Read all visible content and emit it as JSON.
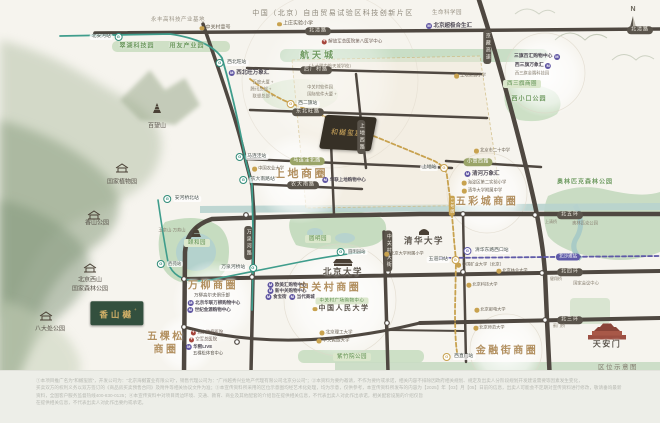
{
  "project": {
    "block_name": "和樾玺宸",
    "block_sup": "+",
    "badge_name": "香山樾",
    "badge_sup": "+"
  },
  "compass": {
    "north_label": "N"
  },
  "footer": {
    "caption": "区位示意图",
    "disclaimer_lines": [
      "①本项目推广名为“和樾玺宸”，开发公司为：“北京海樾置业有限公司”，销售代理公司为：“广州越秀兴业地产代理有限公司北京分公司”；②本资料为要约邀请，不作为要约或承诺，相关内容不排除因政府相关规划、规定及出卖人分阶段规划开发建设需要等因素发生变化，",
      "买卖双方的权利义务以双方签订的《商品房买卖预售合同》及附件等相关协议文件为准；③本宣传资料所采用的区位示意图均经艺术化处理，均为示意，仅供参考，本宣传资料所发布的内容为【2025】年【03】月【05】日前的信息，出卖人可能会不定期对宣传资料进行修改，敬请垂询最新",
      "资料，全国客户服务监督热线400-830-0125；④本宣传资料中对项目周边环境、交通、教育、商业及其他配套的介绍旨在提供相关信息，不代表出卖人对此作出承诺，相关配套设施的介绍仅旨",
      "在提供相关信息，不代表出卖人对此作出要约或承诺。"
    ]
  },
  "colors": {
    "road": "#4f4841",
    "metro_green": "#3f9d8c",
    "metro_gold": "#c8a24f",
    "metro_purple": "#5f5aa8",
    "district_text": "#b29060",
    "park_fill": "#cddec3",
    "water_fill": "#b4d2cd",
    "badge_green": "#33503e",
    "badge_gold": "#d2b068"
  },
  "map": {
    "labels": [
      {
        "n": "label-north",
        "t": "N",
        "x": 633,
        "y": 10,
        "c": "north"
      },
      {
        "n": "label-yongfeng-base",
        "t": "永丰高科技产业基地",
        "x": 178,
        "y": 20,
        "c": "gray"
      },
      {
        "n": "label-zgc-no1",
        "t": "中关村壹号",
        "x": 215,
        "y": 28,
        "c": "school",
        "fs": 5
      },
      {
        "n": "label-ftz-title",
        "t": "中国（北京）自由贸易试验区科技创新片区",
        "x": 333,
        "y": 14,
        "c": "title"
      },
      {
        "n": "label-shangzhuang-school",
        "t": "上庄实验小学",
        "x": 295,
        "y": 24,
        "c": "school"
      },
      {
        "n": "label-life-science-park",
        "t": "生命科学园",
        "x": 447,
        "y": 13,
        "c": "gray"
      },
      {
        "n": "label-hopson-mall",
        "t": "北京超极合生汇",
        "x": 449,
        "y": 26,
        "c": "mall"
      },
      {
        "n": "station-beianhe",
        "t": "北安河站",
        "x": 106,
        "y": 37,
        "c": "m16",
        "ir": 1
      },
      {
        "n": "road-beiqinglu-w",
        "t": "北清路",
        "x": 318,
        "y": 31,
        "c": "road"
      },
      {
        "n": "road-beiqinglu-e",
        "t": "北清路",
        "x": 640,
        "y": 30,
        "c": "road"
      },
      {
        "n": "label-cuihu-park",
        "t": "翠湖科技园",
        "x": 137,
        "y": 47,
        "c": "park"
      },
      {
        "n": "label-yonyou-park",
        "t": "用友产业园",
        "x": 187,
        "y": 47,
        "c": "park"
      },
      {
        "n": "label-hangtiancheng",
        "t": "航天城",
        "x": 318,
        "y": 56,
        "c": "park",
        "fs": 9,
        "ls": 3
      },
      {
        "n": "label-pla-hospital",
        "t": "解放军总医院第八医学中心",
        "x": 352,
        "y": 42,
        "c": "hosp"
      },
      {
        "n": "label-rdfz-hangtiancheng",
        "t": "（人大附中航天城学校）",
        "x": 330,
        "y": 67,
        "c": "tiny"
      },
      {
        "n": "station-xibeiwang",
        "t": "西北旺站",
        "x": 232,
        "y": 63,
        "c": "m16"
      },
      {
        "n": "label-xibeiwang-mixc",
        "t": "西北旺万象汇",
        "x": 249,
        "y": 73,
        "c": "mall"
      },
      {
        "n": "road-houchangcun",
        "t": "后厂村路",
        "x": 316,
        "y": 70,
        "c": "road"
      },
      {
        "n": "road-dongbeiwang",
        "t": "东北旺路",
        "x": 308,
        "y": 112,
        "c": "road"
      },
      {
        "n": "road-shangdixi",
        "t": "上地西路",
        "x": 361,
        "y": 137,
        "c": "roadv"
      },
      {
        "n": "road-jingzang-expwy",
        "t": "京藏高速",
        "x": 487,
        "y": 47,
        "c": "roadv"
      },
      {
        "n": "station-xierqi",
        "t": "西二旗站",
        "x": 303,
        "y": 104,
        "c": "m13"
      },
      {
        "n": "label-sanqibaihui",
        "t": "三旗百汇购物中心",
        "x": 537,
        "y": 57,
        "c": "mall",
        "fs": 4.8,
        "ir": 1
      },
      {
        "n": "label-xisanqi-mixc",
        "t": "西三旗万象汇",
        "x": 533,
        "y": 66,
        "c": "mall",
        "fs": 4.8,
        "ir": 1
      },
      {
        "n": "label-xisanqi-tech-park",
        "t": "西三旗金隅科技园",
        "x": 532,
        "y": 74,
        "c": "tiny"
      },
      {
        "n": "label-xisanqi-district",
        "t": "西三旗商圈",
        "x": 522,
        "y": 84,
        "c": "parkpill"
      },
      {
        "n": "label-xixiaokou-park",
        "t": "西小口公园",
        "x": 529,
        "y": 100,
        "c": "park"
      },
      {
        "n": "label-no20-school",
        "t": "北京市二十中学",
        "x": 492,
        "y": 151,
        "c": "school",
        "fs": 4.3
      },
      {
        "n": "road-xiaoyingxi",
        "t": "小营西路",
        "x": 478,
        "y": 162,
        "c": "roado"
      },
      {
        "n": "station-shangdi",
        "t": "上地站",
        "x": 434,
        "y": 168,
        "c": "m13",
        "ir": 1
      },
      {
        "n": "label-qinghe-mixc",
        "t": "清河万象汇",
        "x": 482,
        "y": 174,
        "c": "mall"
      },
      {
        "n": "label-haidian-exp-school",
        "t": "海淀区第二实验小学",
        "x": 484,
        "y": 183,
        "c": "school",
        "fs": 4.3
      },
      {
        "n": "label-qinghua-fuzhong",
        "t": "清华大学附属中学",
        "x": 482,
        "y": 191,
        "c": "school",
        "fs": 4.3
      },
      {
        "n": "label-wucaicheng-district",
        "t": "五彩城商圈",
        "x": 487,
        "y": 202,
        "c": "district",
        "fs": 10
      },
      {
        "n": "label-shangdi-district",
        "t": "上地商圈",
        "x": 301,
        "y": 174,
        "c": "district"
      },
      {
        "n": "road-malianwabei",
        "t": "马连洼北路",
        "x": 307,
        "y": 161,
        "c": "roado"
      },
      {
        "n": "road-nongdanan",
        "t": "农大南路",
        "x": 303,
        "y": 185,
        "c": "road"
      },
      {
        "n": "station-malianwa",
        "t": "马连洼站",
        "x": 252,
        "y": 157,
        "c": "m16"
      },
      {
        "n": "station-nongdananlu",
        "t": "农大南路站",
        "x": 258,
        "y": 180,
        "c": "m16"
      },
      {
        "n": "label-cau",
        "t": "中国农业大学",
        "x": 268,
        "y": 169,
        "c": "school",
        "fs": 4.3
      },
      {
        "n": "label-shangdi-school",
        "t": "上地实验小学",
        "x": 470,
        "y": 76,
        "c": "school",
        "fs": 4.3
      },
      {
        "n": "station-anheqiaobei",
        "t": "安河桥北站",
        "x": 182,
        "y": 199,
        "c": "m16"
      },
      {
        "n": "label-yuquanshan",
        "t": "玉泉山·万寿山",
        "x": 172,
        "y": 231,
        "c": "tiny"
      },
      {
        "n": "label-summer-palace",
        "t": "颐和园",
        "x": 197,
        "y": 243,
        "c": "parkpill"
      },
      {
        "n": "station-xiyuan",
        "t": "西苑站",
        "x": 170,
        "y": 264,
        "c": "m16",
        "fs": 4.3
      },
      {
        "n": "station-wanquanheqiao",
        "t": "万泉河桥站",
        "x": 238,
        "y": 268,
        "c": "m16",
        "ir": 1
      },
      {
        "n": "road-wanquanhe",
        "t": "万泉河路",
        "x": 248,
        "y": 243,
        "c": "roadv"
      },
      {
        "n": "label-yuanmingyuan",
        "t": "圆明园",
        "x": 318,
        "y": 239,
        "c": "parkpill"
      },
      {
        "n": "station-yuanmingyuan",
        "t": "圆明园站",
        "x": 352,
        "y": 252,
        "c": "m16",
        "fs": 4.3
      },
      {
        "n": "label-pku",
        "t": "北京大学",
        "x": 343,
        "y": 272,
        "c": "uni"
      },
      {
        "n": "road-zhongguancun-st",
        "t": "中关村大街",
        "x": 388,
        "y": 251,
        "c": "roadv"
      },
      {
        "n": "label-tsinghua",
        "t": "清华大学",
        "x": 424,
        "y": 241,
        "c": "uni"
      },
      {
        "n": "label-pku-fuxiao",
        "t": "北京大学附属小学",
        "x": 404,
        "y": 254,
        "c": "school",
        "fs": 4.2
      },
      {
        "n": "station-wudaokou",
        "t": "五道口站",
        "x": 443,
        "y": 260,
        "c": "m13",
        "ir": 1
      },
      {
        "n": "station-qinghuadongluxikou",
        "t": "清华东路西口站",
        "x": 487,
        "y": 251,
        "c": "m15"
      },
      {
        "n": "station-beishatan",
        "t": "北沙滩站",
        "x": 568,
        "y": 257,
        "c": "purplepill"
      },
      {
        "n": "badge-line13",
        "t": "13号线",
        "x": 452,
        "y": 206,
        "c": "goldtagv"
      },
      {
        "n": "label-cumtb",
        "t": "中国矿业大学（北京）",
        "x": 480,
        "y": 265,
        "c": "school",
        "fs": 4.2
      },
      {
        "n": "label-bjfu",
        "t": "北京林业大学",
        "x": 512,
        "y": 271,
        "c": "school",
        "fs": 4.2
      },
      {
        "n": "label-ustb",
        "t": "北京科技大学",
        "x": 482,
        "y": 285,
        "c": "school",
        "fs": 4.2
      },
      {
        "n": "label-bupt",
        "t": "北京邮电大学",
        "x": 490,
        "y": 310,
        "c": "school",
        "fs": 4.2
      },
      {
        "n": "label-zgc-district",
        "t": "中关村商圈",
        "x": 330,
        "y": 288,
        "c": "district",
        "fs": 10
      },
      {
        "n": "label-oumeihui",
        "t": "欧美汇购物中心",
        "x": 287,
        "y": 285,
        "c": "mall",
        "fs": 4.5
      },
      {
        "n": "label-xinzhongguan",
        "t": "新中关购物中心",
        "x": 287,
        "y": 291,
        "c": "mall",
        "fs": 4.5
      },
      {
        "n": "label-shibaojie",
        "t": "食宝街",
        "x": 276,
        "y": 297,
        "c": "mall",
        "fs": 4.5
      },
      {
        "n": "label-dangdai",
        "t": "当代商城",
        "x": 302,
        "y": 297,
        "c": "mall",
        "fs": 4.5
      },
      {
        "n": "label-zgc-plaza",
        "t": "中关村广场购物中心",
        "x": 342,
        "y": 301,
        "c": "parkpill",
        "fs": 4.5
      },
      {
        "n": "label-ruc",
        "t": "中国人民大学",
        "x": 341,
        "y": 309,
        "c": "uni",
        "fs": 7,
        "d": 1
      },
      {
        "n": "label-bit",
        "t": "北京理工大学",
        "x": 336,
        "y": 333,
        "c": "school",
        "fs": 4.5
      },
      {
        "n": "label-muc",
        "t": "中央民族大学",
        "x": 333,
        "y": 341,
        "c": "school",
        "fs": 4.5
      },
      {
        "n": "label-zizhuyuan-park",
        "t": "紫竹院公园",
        "x": 352,
        "y": 357,
        "c": "parkpill"
      },
      {
        "n": "label-wanliu-district",
        "t": "万柳商圈",
        "x": 213,
        "y": 286,
        "c": "district",
        "fs": 10
      },
      {
        "n": "label-wanliu-golf",
        "t": "万柳高尔夫俱乐部",
        "x": 212,
        "y": 296,
        "c": "poi",
        "fs": 4.5
      },
      {
        "n": "label-bhg-wanliu",
        "t": "北京华联万柳购物中心",
        "x": 214,
        "y": 303,
        "c": "mall",
        "fs": 4.5
      },
      {
        "n": "label-jinyuan-mall",
        "t": "世纪金源购物中心",
        "x": 209,
        "y": 310,
        "c": "mall",
        "fs": 4.5
      },
      {
        "n": "label-wukesong-line1",
        "t": "五棵松",
        "x": 166,
        "y": 337,
        "c": "district",
        "fs": 10
      },
      {
        "n": "label-wukesong-line2",
        "t": "商圈",
        "x": 166,
        "y": 350,
        "c": "district",
        "fs": 10
      },
      {
        "n": "label-cancer-hospital",
        "t": "北京肿瘤医院",
        "x": 207,
        "y": 333,
        "c": "hosp",
        "fs": 4.3
      },
      {
        "n": "label-kongjun-hospital",
        "t": "空军总医院",
        "x": 203,
        "y": 340,
        "c": "hosp",
        "fs": 4.3
      },
      {
        "n": "label-huaxi-live",
        "t": "华熙LIVE",
        "x": 199,
        "y": 347,
        "c": "mall",
        "fs": 4.5
      },
      {
        "n": "label-wks-arena",
        "t": "五棵松体育中心",
        "x": 208,
        "y": 354,
        "c": "poi",
        "fs": 4.3
      },
      {
        "n": "label-jinrongjie-district",
        "t": "金融街商圈",
        "x": 507,
        "y": 351,
        "c": "district",
        "fs": 10
      },
      {
        "n": "station-xizhimen",
        "t": "西直门站",
        "x": 459,
        "y": 357,
        "c": "m13"
      },
      {
        "n": "label-bnu",
        "t": "北京师范大学",
        "x": 489,
        "y": 328,
        "c": "school",
        "fs": 4.2
      },
      {
        "n": "road-beiwuhuan",
        "t": "北五环",
        "x": 570,
        "y": 215,
        "c": "road"
      },
      {
        "n": "road-beisihuan",
        "t": "北四环",
        "x": 570,
        "y": 272,
        "c": "road"
      },
      {
        "n": "road-beisanhuan",
        "t": "北三环",
        "x": 570,
        "y": 320,
        "c": "road"
      },
      {
        "n": "label-shangqing-bridge",
        "t": "上清桥",
        "x": 551,
        "y": 222,
        "c": "tiny",
        "fs": 4
      },
      {
        "n": "label-jianxiang-bridge",
        "t": "健翔桥",
        "x": 556,
        "y": 279,
        "c": "tiny",
        "fs": 4
      },
      {
        "n": "label-jimen-bridge",
        "t": "蓟门桥",
        "x": 559,
        "y": 326,
        "c": "tiny",
        "fs": 4
      },
      {
        "n": "label-aosen-park",
        "t": "奥林匹克森林公园",
        "x": 585,
        "y": 183,
        "c": "park"
      },
      {
        "n": "label-olympic-park",
        "t": "奥林匹克公园",
        "x": 585,
        "y": 224,
        "c": "tiny"
      },
      {
        "n": "label-national-convention",
        "t": "国家会议中心",
        "x": 586,
        "y": 284,
        "c": "tiny"
      },
      {
        "n": "label-tiananmen",
        "t": "天安门",
        "x": 607,
        "y": 345,
        "c": "uni",
        "fs": 8
      },
      {
        "n": "label-xiangshan-park",
        "t": "香山公园",
        "x": 97,
        "y": 224,
        "c": "poi",
        "fs": 6
      },
      {
        "n": "label-xishan-line1",
        "t": "北京西山",
        "x": 90,
        "y": 281,
        "c": "poi",
        "fs": 6
      },
      {
        "n": "label-xishan-line2",
        "t": "国家森林公园",
        "x": 90,
        "y": 290,
        "c": "poi",
        "fs": 6
      },
      {
        "n": "label-badachu-park",
        "t": "八大处公园",
        "x": 50,
        "y": 330,
        "c": "poi",
        "fs": 6
      },
      {
        "n": "label-botanical-garden",
        "t": "国家植物园",
        "x": 122,
        "y": 183,
        "c": "poi",
        "fs": 6
      },
      {
        "n": "label-baiwangshan",
        "t": "百望山",
        "x": 157,
        "y": 127,
        "c": "poi",
        "fs": 6
      },
      {
        "n": "label-software-baidu",
        "t": "百度大厦 +",
        "x": 263,
        "y": 83,
        "c": "tiny"
      },
      {
        "n": "label-software-tencent",
        "t": "腾讯总部 +",
        "x": 261,
        "y": 90,
        "c": "tiny"
      },
      {
        "n": "label-software-lenovo",
        "t": "联想总部 +",
        "x": 263,
        "y": 97,
        "c": "tiny"
      },
      {
        "n": "label-zgc-software-park",
        "t": "中关村软件园",
        "x": 320,
        "y": 88,
        "c": "tiny"
      },
      {
        "n": "label-software-intl",
        "t": "国际软件大厦 +",
        "x": 322,
        "y": 95,
        "c": "tiny"
      },
      {
        "n": "label-hualian-shangdi",
        "t": "华联上地购物中心",
        "x": 344,
        "y": 180,
        "c": "mall",
        "fs": 4.5
      }
    ]
  }
}
